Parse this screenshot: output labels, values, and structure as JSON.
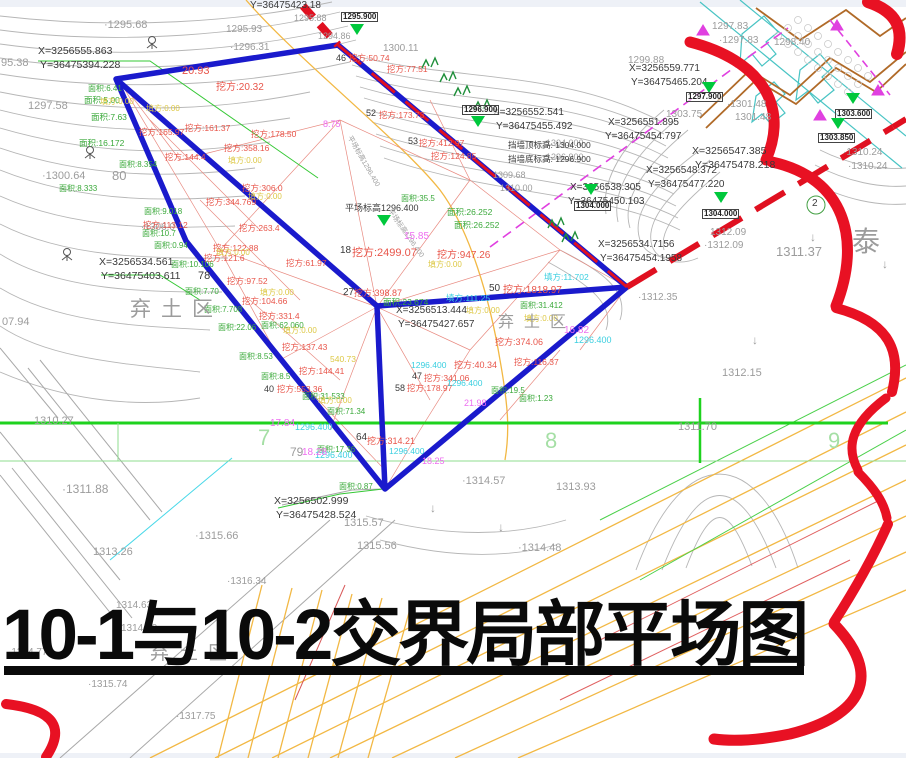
{
  "title": {
    "text": "10-1与10-2交界局部平场图"
  },
  "palette": {
    "g": "#3aa93a",
    "r": "#e8554a",
    "y": "#ddc844",
    "cy": "#3bcfe0",
    "m": "#ee6ef0",
    "k": "#3a3a3a",
    "gr": "#9c9c9c",
    "lg": "#a5dfa5",
    "boundary_blue": "#1a1acc",
    "revision_red": "#e81123",
    "gridline_green": "#1ed21e",
    "road_orange": "#f2b844",
    "marker_green": "#00c83c",
    "contour_gray": "#b6b6b6"
  },
  "regions": [
    {
      "t": "弃土区",
      "x": 130,
      "y": 293,
      "s": 21
    },
    {
      "t": "弃土区",
      "x": 498,
      "y": 308,
      "s": 16
    },
    {
      "t": "弃土区",
      "x": 150,
      "y": 638,
      "s": 19
    }
  ],
  "grid_numbers": [
    {
      "t": "7",
      "x": 258,
      "y": 425
    },
    {
      "t": "8",
      "x": 545,
      "y": 428
    },
    {
      "t": "9",
      "x": 828,
      "y": 428
    }
  ],
  "markers": [
    {
      "x": 357,
      "y": 30,
      "label": "1295.900",
      "lx": 341,
      "ly": 12
    },
    {
      "x": 478,
      "y": 122,
      "label": "1296.900",
      "lx": 462,
      "ly": 105
    },
    {
      "x": 709,
      "y": 88,
      "label": "1297.900",
      "lx": 686,
      "ly": 92
    },
    {
      "x": 591,
      "y": 190,
      "label": "1304.000",
      "lx": 574,
      "ly": 201
    },
    {
      "x": 721,
      "y": 198,
      "label": "1304.000",
      "lx": 702,
      "ly": 209
    },
    {
      "x": 853,
      "y": 99,
      "label": "1303.600",
      "lx": 835,
      "ly": 109
    },
    {
      "x": 838,
      "y": 124,
      "label": "1303.850",
      "lx": 818,
      "ly": 133
    },
    {
      "x": 384,
      "y": 221,
      "label": "",
      "lx": 0,
      "ly": 0
    }
  ],
  "labels": [
    {
      "t": "·1295.68",
      "x": 104,
      "y": 20,
      "c": "gr",
      "s": 11
    },
    {
      "t": "95.38",
      "x": 1,
      "y": 58,
      "c": "gr",
      "s": 11
    },
    {
      "t": "1297.58",
      "x": 28,
      "y": 101,
      "c": "gr",
      "s": 11
    },
    {
      "t": "·1300.64",
      "x": 42,
      "y": 171,
      "c": "gr",
      "s": 11
    },
    {
      "t": "·1306.0",
      "x": 141,
      "y": 223,
      "c": "gr",
      "s": 10
    },
    {
      "t": "07.94",
      "x": 2,
      "y": 317,
      "c": "gr",
      "s": 11
    },
    {
      "t": "1310.27",
      "x": 34,
      "y": 416,
      "c": "gr",
      "s": 11
    },
    {
      "t": "·1311.88",
      "x": 62,
      "y": 483,
      "c": "gr",
      "s": 12
    },
    {
      "t": "·1315.66",
      "x": 195,
      "y": 531,
      "c": "gr",
      "s": 11
    },
    {
      "t": "1313.26",
      "x": 93,
      "y": 547,
      "c": "gr",
      "s": 11
    },
    {
      "t": "·1316.34",
      "x": 227,
      "y": 577,
      "c": "gr",
      "s": 10
    },
    {
      "t": "1314.63",
      "x": 116,
      "y": 601,
      "c": "gr",
      "s": 10
    },
    {
      "t": "1314.80",
      "x": 121,
      "y": 624,
      "c": "gr",
      "s": 10
    },
    {
      "t": "·1314.77",
      "x": 8,
      "y": 648,
      "c": "gr",
      "s": 10
    },
    {
      "t": "·1315.74",
      "x": 88,
      "y": 680,
      "c": "gr",
      "s": 10
    },
    {
      "t": "·1317.75",
      "x": 176,
      "y": 712,
      "c": "gr",
      "s": 10
    },
    {
      "t": "1315.57",
      "x": 344,
      "y": 518,
      "c": "gr",
      "s": 11
    },
    {
      "t": "1315.56",
      "x": 357,
      "y": 541,
      "c": "gr",
      "s": 11
    },
    {
      "t": "·1314.57",
      "x": 462,
      "y": 476,
      "c": "gr",
      "s": 11
    },
    {
      "t": "·1314.48",
      "x": 518,
      "y": 543,
      "c": "gr",
      "s": 11
    },
    {
      "t": "1313.93",
      "x": 556,
      "y": 482,
      "c": "gr",
      "s": 11
    },
    {
      "t": "1312.15",
      "x": 722,
      "y": 368,
      "c": "gr",
      "s": 11
    },
    {
      "t": "1311.37",
      "x": 776,
      "y": 245,
      "c": "gr",
      "s": 13
    },
    {
      "t": "1311.70",
      "x": 678,
      "y": 422,
      "c": "gr",
      "s": 11
    },
    {
      "t": "·1310.24",
      "x": 843,
      "y": 148,
      "c": "gr",
      "s": 10
    },
    {
      "t": "·1310.24",
      "x": 848,
      "y": 162,
      "c": "gr",
      "s": 10
    },
    {
      "t": "1312.09",
      "x": 710,
      "y": 228,
      "c": "gr",
      "s": 10
    },
    {
      "t": "·1312.09",
      "x": 704,
      "y": 241,
      "c": "gr",
      "s": 10
    },
    {
      "t": "·1312.35",
      "x": 638,
      "y": 293,
      "c": "gr",
      "s": 10
    },
    {
      "t": "1309.68",
      "x": 493,
      "y": 171,
      "c": "gr",
      "s": 9
    },
    {
      "t": "1310.00",
      "x": 500,
      "y": 184,
      "c": "gr",
      "s": 9
    },
    {
      "t": "1300.11",
      "x": 383,
      "y": 44,
      "c": "gr",
      "s": 10
    },
    {
      "t": "1295.93",
      "x": 226,
      "y": 25,
      "c": "gr",
      "s": 10
    },
    {
      "t": "·1296.31",
      "x": 230,
      "y": 43,
      "c": "gr",
      "s": 10
    },
    {
      "t": "1295.88",
      "x": 294,
      "y": 14,
      "c": "gr",
      "s": 9
    },
    {
      "t": "1294.86",
      "x": 318,
      "y": 32,
      "c": "gr",
      "s": 9
    },
    {
      "t": "1297.83",
      "x": 712,
      "y": 22,
      "c": "gr",
      "s": 10
    },
    {
      "t": "·1297.83",
      "x": 719,
      "y": 36,
      "c": "gr",
      "s": 10
    },
    {
      "t": "1298.40",
      "x": 774,
      "y": 38,
      "c": "gr",
      "s": 10
    },
    {
      "t": "·1301.48",
      "x": 727,
      "y": 100,
      "c": "gr",
      "s": 10
    },
    {
      "t": "1301.48",
      "x": 735,
      "y": 113,
      "c": "gr",
      "s": 10
    },
    {
      "t": "1303.75",
      "x": 666,
      "y": 110,
      "c": "gr",
      "s": 10
    },
    {
      "t": "1299.88",
      "x": 628,
      "y": 56,
      "c": "gr",
      "s": 10
    },
    {
      "t": "1304.000",
      "x": 546,
      "y": 139,
      "c": "gr",
      "s": 9
    },
    {
      "t": "1296.900",
      "x": 546,
      "y": 153,
      "c": "gr",
      "s": 9
    },
    {
      "t": "泰",
      "x": 852,
      "y": 228,
      "c": "gr",
      "s": 28
    },
    {
      "t": "X=3256555.863",
      "x": 38,
      "y": 46,
      "c": "k",
      "s": 10.5
    },
    {
      "t": "Y=36475394.228",
      "x": 40,
      "y": 60,
      "c": "k",
      "s": 10.5
    },
    {
      "t": "X=3256534.561",
      "x": 99,
      "y": 257,
      "c": "k",
      "s": 10.5
    },
    {
      "t": "Y=36475403.611",
      "x": 101,
      "y": 271,
      "c": "k",
      "s": 10.5
    },
    {
      "t": "Y=36475423.18",
      "x": 250,
      "y": 1,
      "c": "k",
      "s": 10
    },
    {
      "t": "X=3256552.541",
      "x": 493,
      "y": 108,
      "c": "k",
      "s": 10
    },
    {
      "t": "Y=36475455.492",
      "x": 496,
      "y": 122,
      "c": "k",
      "s": 10
    },
    {
      "t": "X=3256559.771",
      "x": 629,
      "y": 64,
      "c": "k",
      "s": 10
    },
    {
      "t": "Y=36475465.204",
      "x": 631,
      "y": 78,
      "c": "k",
      "s": 10
    },
    {
      "t": "X=3256551.895",
      "x": 608,
      "y": 118,
      "c": "k",
      "s": 10
    },
    {
      "t": "Y=36475454.797",
      "x": 605,
      "y": 132,
      "c": "k",
      "s": 10
    },
    {
      "t": "X=3256547.385",
      "x": 692,
      "y": 146,
      "c": "k",
      "s": 10.5
    },
    {
      "t": "Y=36475478.218",
      "x": 695,
      "y": 160,
      "c": "k",
      "s": 10.5
    },
    {
      "t": "X=3256548.372",
      "x": 646,
      "y": 166,
      "c": "k",
      "s": 10
    },
    {
      "t": "Y=36475477.220",
      "x": 648,
      "y": 180,
      "c": "k",
      "s": 10
    },
    {
      "t": "X=3256538.305",
      "x": 570,
      "y": 183,
      "c": "k",
      "s": 10
    },
    {
      "t": "Y=36475450.103",
      "x": 568,
      "y": 197,
      "c": "k",
      "s": 10
    },
    {
      "t": "X=3256534.7156",
      "x": 598,
      "y": 240,
      "c": "k",
      "s": 10
    },
    {
      "t": "Y=36475454.1958",
      "x": 600,
      "y": 254,
      "c": "k",
      "s": 10
    },
    {
      "t": "X=3256513.444",
      "x": 396,
      "y": 306,
      "c": "k",
      "s": 10
    },
    {
      "t": "Y=36475427.657",
      "x": 398,
      "y": 320,
      "c": "k",
      "s": 10
    },
    {
      "t": "X=3256502.999",
      "x": 274,
      "y": 496,
      "c": "k",
      "s": 10.5
    },
    {
      "t": "Y=36475428.524",
      "x": 276,
      "y": 510,
      "c": "k",
      "s": 10.5
    },
    {
      "t": "挡墙顶标高: 1304.000",
      "x": 508,
      "y": 141,
      "c": "k",
      "s": 8.5
    },
    {
      "t": "挡墙底标高: 1296.900",
      "x": 508,
      "y": 155,
      "c": "k",
      "s": 8.5
    },
    {
      "t": "平场标高1296.400",
      "x": 345,
      "y": 204,
      "c": "k",
      "s": 9
    },
    {
      "t": "平场标高1296.400",
      "x": 392,
      "y": 208,
      "c": "gr",
      "s": 7,
      "r": 55
    },
    {
      "t": "平场标高1296.400",
      "x": 352,
      "y": 135,
      "c": "gr",
      "s": 7,
      "r": 60
    },
    {
      "t": "80",
      "x": 112,
      "y": 169,
      "c": "gr",
      "s": 13
    },
    {
      "t": "79",
      "x": 290,
      "y": 446,
      "c": "gr",
      "s": 12
    },
    {
      "t": "78",
      "x": 198,
      "y": 271,
      "c": "k",
      "s": 11
    },
    {
      "t": "64",
      "x": 356,
      "y": 433,
      "c": "k",
      "s": 10
    },
    {
      "t": "18",
      "x": 340,
      "y": 246,
      "c": "k",
      "s": 10
    },
    {
      "t": "50",
      "x": 489,
      "y": 284,
      "c": "k",
      "s": 10
    },
    {
      "t": "27",
      "x": 343,
      "y": 288,
      "c": "k",
      "s": 10
    },
    {
      "t": "46",
      "x": 336,
      "y": 54,
      "c": "k",
      "s": 9
    },
    {
      "t": "52",
      "x": 366,
      "y": 109,
      "c": "k",
      "s": 9
    },
    {
      "t": "53",
      "x": 408,
      "y": 137,
      "c": "k",
      "s": 9
    },
    {
      "t": "47",
      "x": 412,
      "y": 372,
      "c": "k",
      "s": 9
    },
    {
      "t": "58",
      "x": 395,
      "y": 384,
      "c": "k",
      "s": 9
    },
    {
      "t": "40",
      "x": 264,
      "y": 385,
      "c": "k",
      "s": 9
    },
    {
      "t": "2",
      "x": 812,
      "y": 199,
      "c": "k",
      "s": 10
    },
    {
      "t": "面积:6.41",
      "x": 88,
      "y": 85,
      "c": "g",
      "s": 8
    },
    {
      "t": "面积:5.00",
      "x": 84,
      "y": 96,
      "c": "g",
      "s": 8.5
    },
    {
      "t": "面积:7.63",
      "x": 91,
      "y": 113,
      "c": "g",
      "s": 8.5
    },
    {
      "t": "面积:16.172",
      "x": 79,
      "y": 139,
      "c": "g",
      "s": 8.5
    },
    {
      "t": "面积:8.354",
      "x": 119,
      "y": 161,
      "c": "g",
      "s": 8
    },
    {
      "t": "面积:8.333",
      "x": 59,
      "y": 185,
      "c": "g",
      "s": 8
    },
    {
      "t": "面积:9.018",
      "x": 144,
      "y": 208,
      "c": "g",
      "s": 8
    },
    {
      "t": "面积:10.7",
      "x": 142,
      "y": 230,
      "c": "g",
      "s": 8
    },
    {
      "t": "面积:0.94",
      "x": 154,
      "y": 242,
      "c": "g",
      "s": 8
    },
    {
      "t": "面积:10.106",
      "x": 171,
      "y": 261,
      "c": "g",
      "s": 8
    },
    {
      "t": "面积:7.70",
      "x": 185,
      "y": 288,
      "c": "g",
      "s": 8
    },
    {
      "t": "面积:7.708",
      "x": 204,
      "y": 306,
      "c": "g",
      "s": 8
    },
    {
      "t": "面积:22.06",
      "x": 218,
      "y": 324,
      "c": "g",
      "s": 8
    },
    {
      "t": "面积:62.060",
      "x": 261,
      "y": 322,
      "c": "g",
      "s": 8
    },
    {
      "t": "面积:8.53",
      "x": 239,
      "y": 353,
      "c": "g",
      "s": 8
    },
    {
      "t": "面积:8.5",
      "x": 261,
      "y": 373,
      "c": "g",
      "s": 8
    },
    {
      "t": "面积:31.533",
      "x": 302,
      "y": 393,
      "c": "g",
      "s": 8
    },
    {
      "t": "面积:71.34",
      "x": 327,
      "y": 408,
      "c": "g",
      "s": 8
    },
    {
      "t": "面积:35.5",
      "x": 401,
      "y": 195,
      "c": "g",
      "s": 8
    },
    {
      "t": "面积:26.252",
      "x": 447,
      "y": 208,
      "c": "g",
      "s": 8.5
    },
    {
      "t": "面积:26.252",
      "x": 454,
      "y": 221,
      "c": "g",
      "s": 8.5
    },
    {
      "t": "面积:23.674",
      "x": 383,
      "y": 298,
      "c": "g",
      "s": 8.5
    },
    {
      "t": "面积:31.412",
      "x": 520,
      "y": 302,
      "c": "g",
      "s": 8
    },
    {
      "t": "面积:19.5",
      "x": 491,
      "y": 387,
      "c": "g",
      "s": 8
    },
    {
      "t": "面积:1.23",
      "x": 519,
      "y": 395,
      "c": "g",
      "s": 8
    },
    {
      "t": "面积:17.36",
      "x": 317,
      "y": 446,
      "c": "g",
      "s": 8
    },
    {
      "t": "面积:0.87",
      "x": 339,
      "y": 483,
      "c": "g",
      "s": 8
    },
    {
      "t": "20.93",
      "x": 182,
      "y": 66,
      "c": "r",
      "s": 11
    },
    {
      "t": "挖方:20.32",
      "x": 216,
      "y": 83,
      "c": "r",
      "s": 10
    },
    {
      "t": "挖方:161.37",
      "x": 185,
      "y": 124,
      "c": "r",
      "s": 8.5
    },
    {
      "t": "挖方:165.97",
      "x": 139,
      "y": 128,
      "c": "r",
      "s": 8.5
    },
    {
      "t": "挖方:178.50",
      "x": 251,
      "y": 130,
      "c": "r",
      "s": 8.5
    },
    {
      "t": "挖方:144.4",
      "x": 165,
      "y": 153,
      "c": "r",
      "s": 8.5
    },
    {
      "t": "挖方:358.16",
      "x": 224,
      "y": 144,
      "c": "r",
      "s": 8.5
    },
    {
      "t": "挖方:306.0",
      "x": 242,
      "y": 184,
      "c": "r",
      "s": 8.5
    },
    {
      "t": "挖方:344.769",
      "x": 206,
      "y": 198,
      "c": "r",
      "s": 8.5
    },
    {
      "t": "挖方:113.12",
      "x": 143,
      "y": 221,
      "c": "r",
      "s": 8.5
    },
    {
      "t": "挖方:263.4",
      "x": 239,
      "y": 224,
      "c": "r",
      "s": 8.5
    },
    {
      "t": "挖方:122.88",
      "x": 213,
      "y": 244,
      "c": "r",
      "s": 8.5
    },
    {
      "t": "挖方:121.6",
      "x": 204,
      "y": 254,
      "c": "r",
      "s": 8.5
    },
    {
      "t": "挖方:97.52",
      "x": 227,
      "y": 277,
      "c": "r",
      "s": 8.5
    },
    {
      "t": "挖方:104.66",
      "x": 242,
      "y": 297,
      "c": "r",
      "s": 8.5
    },
    {
      "t": "挖方:331.4",
      "x": 259,
      "y": 312,
      "c": "r",
      "s": 8.5
    },
    {
      "t": "挖方:137.43",
      "x": 282,
      "y": 343,
      "c": "r",
      "s": 8.5
    },
    {
      "t": "挖方:144.41",
      "x": 299,
      "y": 367,
      "c": "r",
      "s": 8.5
    },
    {
      "t": "挖方:553.36",
      "x": 277,
      "y": 385,
      "c": "r",
      "s": 8.5
    },
    {
      "t": "挖方:61.97",
      "x": 286,
      "y": 259,
      "c": "r",
      "s": 8.5
    },
    {
      "t": "挖方:314.21",
      "x": 367,
      "y": 437,
      "c": "r",
      "s": 9
    },
    {
      "t": "挖方:178.97",
      "x": 407,
      "y": 384,
      "c": "r",
      "s": 8.5
    },
    {
      "t": "挖方:40.34",
      "x": 454,
      "y": 361,
      "c": "r",
      "s": 9
    },
    {
      "t": "挖方:2499.07",
      "x": 352,
      "y": 248,
      "c": "r",
      "s": 11
    },
    {
      "t": "挖方:947.26",
      "x": 437,
      "y": 251,
      "c": "r",
      "s": 10
    },
    {
      "t": "挖方:398.87",
      "x": 354,
      "y": 289,
      "c": "r",
      "s": 9
    },
    {
      "t": "挖方:1818.97",
      "x": 503,
      "y": 286,
      "c": "r",
      "s": 10
    },
    {
      "t": "挖方:374.06",
      "x": 495,
      "y": 338,
      "c": "r",
      "s": 9
    },
    {
      "t": "挖方:116.37",
      "x": 514,
      "y": 358,
      "c": "r",
      "s": 8.5
    },
    {
      "t": "挖方:341.06",
      "x": 424,
      "y": 374,
      "c": "r",
      "s": 8.5
    },
    {
      "t": "挖方:412.97",
      "x": 419,
      "y": 139,
      "c": "r",
      "s": 8.5
    },
    {
      "t": "挖方:124.85",
      "x": 431,
      "y": 152,
      "c": "r",
      "s": 8.5
    },
    {
      "t": "挖方:173.73",
      "x": 379,
      "y": 111,
      "c": "r",
      "s": 8.5
    },
    {
      "t": "挖方:50.74",
      "x": 349,
      "y": 54,
      "c": "r",
      "s": 8.5
    },
    {
      "t": "挖方:77.51",
      "x": 387,
      "y": 65,
      "c": "r",
      "s": 8.5
    },
    {
      "t": "填方:0.00",
      "x": 100,
      "y": 98,
      "c": "y",
      "s": 8
    },
    {
      "t": "填方:0.00",
      "x": 146,
      "y": 105,
      "c": "y",
      "s": 8
    },
    {
      "t": "填方:0.00",
      "x": 228,
      "y": 157,
      "c": "y",
      "s": 8
    },
    {
      "t": "填方:0.00",
      "x": 248,
      "y": 193,
      "c": "y",
      "s": 8
    },
    {
      "t": "填方:0.00",
      "x": 216,
      "y": 249,
      "c": "y",
      "s": 8
    },
    {
      "t": "填方:0.00",
      "x": 260,
      "y": 289,
      "c": "y",
      "s": 8
    },
    {
      "t": "填方:0.00",
      "x": 283,
      "y": 327,
      "c": "y",
      "s": 8
    },
    {
      "t": "填方:0.00",
      "x": 318,
      "y": 397,
      "c": "y",
      "s": 8
    },
    {
      "t": "填方:0.00",
      "x": 428,
      "y": 261,
      "c": "y",
      "s": 8
    },
    {
      "t": "填方:0.00",
      "x": 466,
      "y": 307,
      "c": "y",
      "s": 8
    },
    {
      "t": "填方:0.00",
      "x": 524,
      "y": 315,
      "c": "y",
      "s": 8
    },
    {
      "t": "540.73",
      "x": 330,
      "y": 355,
      "c": "y",
      "s": 8.5
    },
    {
      "t": "填方:111.25",
      "x": 446,
      "y": 294,
      "c": "cy",
      "s": 8.5
    },
    {
      "t": "填方:11.702",
      "x": 544,
      "y": 273,
      "c": "cy",
      "s": 8.5
    },
    {
      "t": "1296.400",
      "x": 574,
      "y": 336,
      "c": "cy",
      "s": 9
    },
    {
      "t": "1296.400",
      "x": 411,
      "y": 361,
      "c": "cy",
      "s": 8.5
    },
    {
      "t": "1296.400",
      "x": 447,
      "y": 379,
      "c": "cy",
      "s": 8.5
    },
    {
      "t": "1296.400",
      "x": 295,
      "y": 423,
      "c": "cy",
      "s": 9
    },
    {
      "t": "1296.400",
      "x": 315,
      "y": 451,
      "c": "cy",
      "s": 9
    },
    {
      "t": "1296.400",
      "x": 389,
      "y": 447,
      "c": "cy",
      "s": 8.5
    },
    {
      "t": "15.85",
      "x": 404,
      "y": 232,
      "c": "m",
      "s": 10
    },
    {
      "t": "16.82",
      "x": 564,
      "y": 326,
      "c": "m",
      "s": 10
    },
    {
      "t": "17.84",
      "x": 270,
      "y": 419,
      "c": "m",
      "s": 10
    },
    {
      "t": "18.28",
      "x": 302,
      "y": 448,
      "c": "m",
      "s": 10
    },
    {
      "t": "21.98",
      "x": 464,
      "y": 399,
      "c": "m",
      "s": 9
    },
    {
      "t": "18.25",
      "x": 422,
      "y": 457,
      "c": "m",
      "s": 9
    },
    {
      "t": "8.75",
      "x": 323,
      "y": 120,
      "c": "m",
      "s": 9
    },
    {
      "t": "↓",
      "x": 430,
      "y": 502,
      "c": "gr",
      "s": 12
    },
    {
      "t": "↓",
      "x": 498,
      "y": 521,
      "c": "gr",
      "s": 12
    },
    {
      "t": "↓",
      "x": 810,
      "y": 231,
      "c": "gr",
      "s": 12
    },
    {
      "t": "↓",
      "x": 882,
      "y": 258,
      "c": "gr",
      "s": 12
    },
    {
      "t": "↓",
      "x": 752,
      "y": 334,
      "c": "gr",
      "s": 12
    }
  ]
}
